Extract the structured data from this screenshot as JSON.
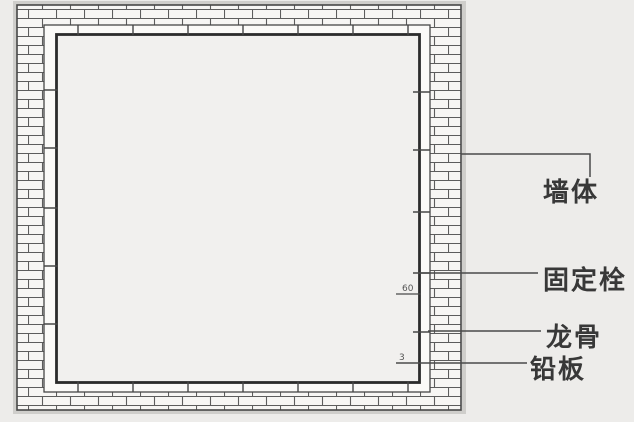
{
  "drawing": {
    "kind": "wall-protection-section-detail",
    "labels": {
      "wall": "墙体",
      "fixing_bolt": "固定栓",
      "keel": "龙骨",
      "lead_plate": "铅板"
    },
    "dimensions": {
      "keel_size": "60",
      "lead_thickness": "3"
    },
    "colors": {
      "background": "#edecea",
      "interior_fill": "#f1f0ee",
      "brick_fill": "#f7f6f4",
      "line": "#474747",
      "lead_line": "#2c2c2c",
      "label_text": "#383838"
    }
  }
}
